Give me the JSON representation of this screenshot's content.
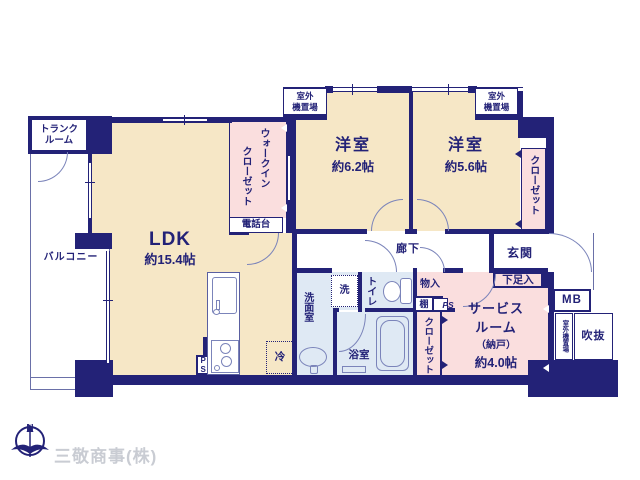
{
  "colors": {
    "wall": "#232277",
    "room_cream": "#f6e7c6",
    "room_pink": "#fadede",
    "room_blue": "#dfe9f4",
    "fixture_line": "#7b84ba",
    "logo_gray": "#c9ccd3"
  },
  "rooms": {
    "ldk": {
      "name": "LDK",
      "size": "約15.4帖"
    },
    "bedroom_a": {
      "name": "洋室",
      "size": "約6.2帖"
    },
    "bedroom_b": {
      "name": "洋室",
      "size": "約5.6帖"
    },
    "service_room": {
      "line1": "サービス",
      "line2": "ルーム",
      "line3": "（納戸）",
      "size": "約4.0帖"
    },
    "balcony": {
      "name": "バルコニー"
    },
    "hallway": {
      "name": "廊下"
    },
    "entrance": {
      "name": "玄関"
    },
    "washroom": {
      "name": "洗面室"
    },
    "toilet": {
      "name": "トイレ"
    },
    "bathroom": {
      "name": "浴室"
    },
    "walk_in_closet": {
      "line1": "ウォークイン",
      "line2": "クローゼット"
    },
    "closet_right": {
      "name": "クローゼット"
    },
    "closet_bottom": {
      "name": "クローゼット"
    },
    "trunk_room": {
      "line1": "トランク",
      "line2": "ルーム"
    },
    "void": {
      "name": "吹抜"
    }
  },
  "fixtures": {
    "phone_stand": "電話台",
    "shoe_cabinet": "下足入",
    "storage": "物入",
    "shelf": "棚",
    "pipe_space_hall": "PS",
    "pipe_space_kitchen": "PS",
    "meter_box": "MB",
    "outdoor_unit": {
      "line1": "室外",
      "line2": "機置場"
    },
    "outdoor_unit_vertical": "室外機置場",
    "washer": "洗",
    "refrigerator": "冷"
  },
  "compass": {
    "north": "N"
  },
  "footer": {
    "company": "三敬商事(株)"
  }
}
